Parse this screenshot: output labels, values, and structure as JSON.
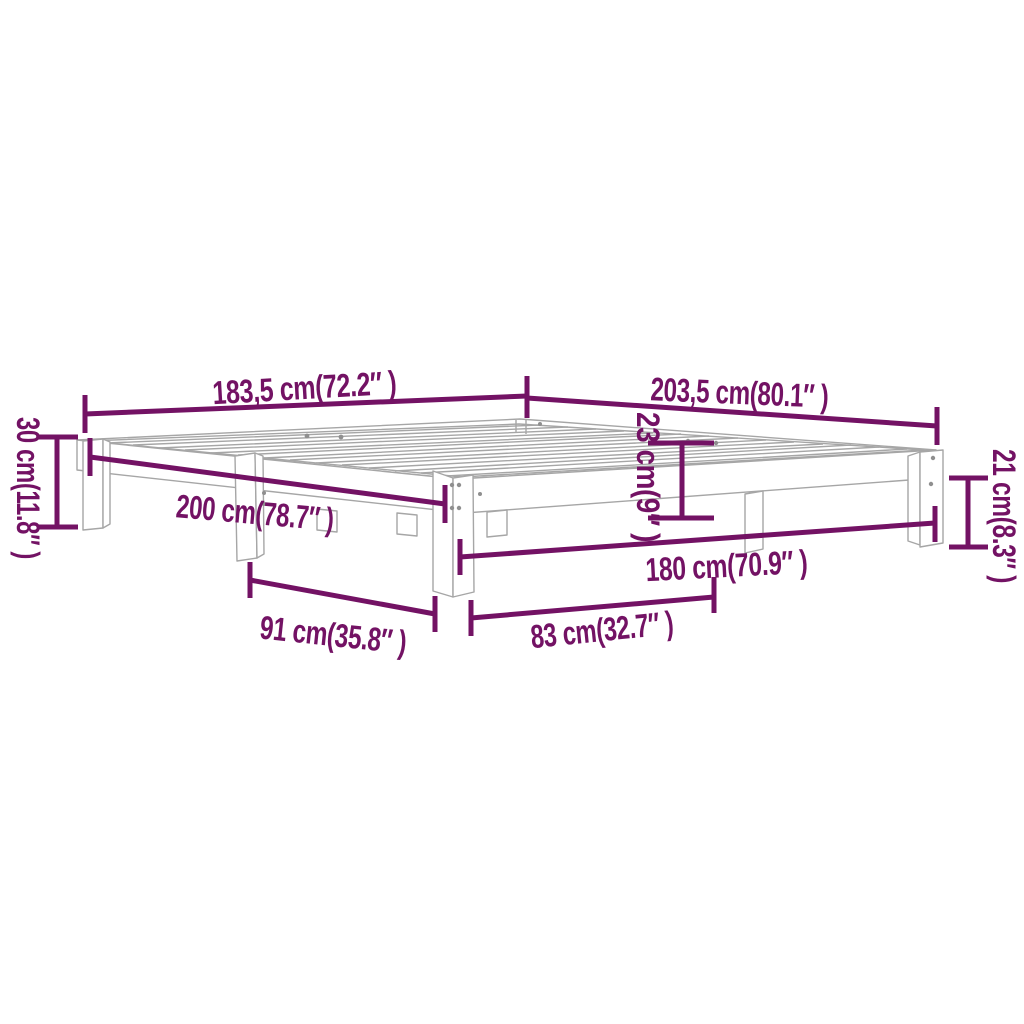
{
  "colors": {
    "accent": "#731264",
    "drawing_line": "#a6a6a6",
    "background": "#ffffff"
  },
  "diagram": {
    "kind": "bed-frame dimension drawing"
  },
  "dimensions": {
    "frame_width_top": {
      "label": "183,5 cm(72.2″ )"
    },
    "frame_length_top": {
      "label": "203,5 cm(80.1″ )"
    },
    "height_left": {
      "label": "30 cm(11.8″ )"
    },
    "length_side": {
      "label": "200 cm(78.7″ )"
    },
    "height_middle": {
      "label": "23 cm(9″ )"
    },
    "height_right": {
      "label": "21 cm(8.3″ )"
    },
    "width_front": {
      "label": "180 cm(70.9″ )"
    },
    "leg_spacing_left": {
      "label": "91 cm(35.8″ )"
    },
    "leg_spacing_front": {
      "label": "83 cm(32.7″ )"
    }
  }
}
